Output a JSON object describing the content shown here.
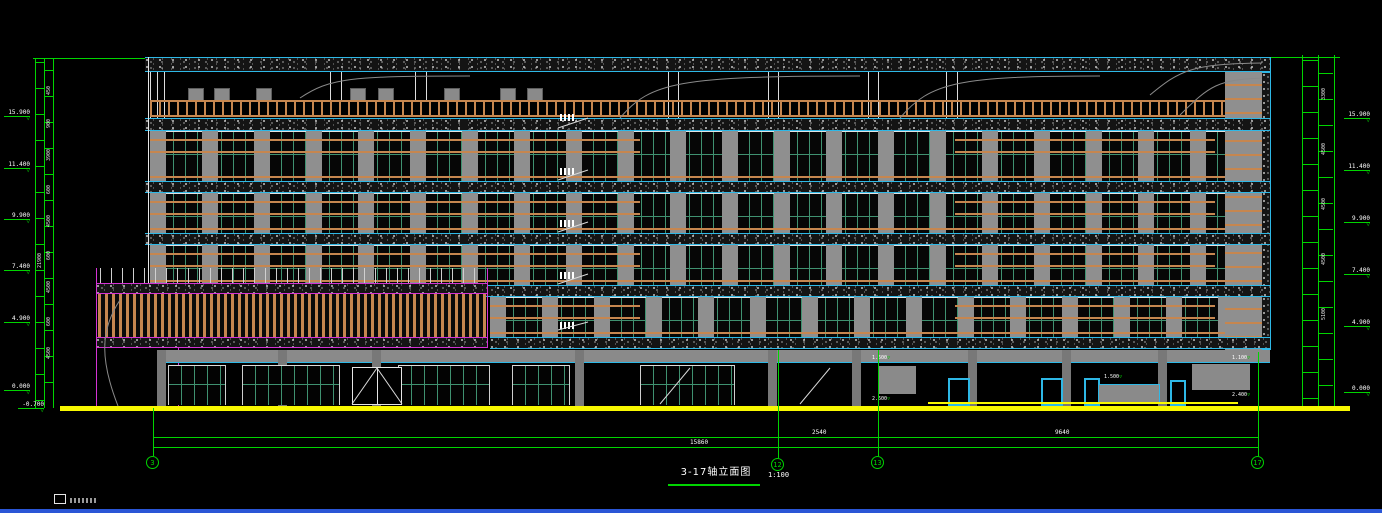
{
  "title_block": {
    "title": "3-17轴立面图",
    "scale": "1:100"
  },
  "grid": {
    "bubbles": [
      {
        "label": "3"
      },
      {
        "label": "12"
      },
      {
        "label": "13"
      },
      {
        "label": "17"
      }
    ]
  },
  "dims_bottom": {
    "seg_3_12": "15860",
    "seg_12_13": "2540",
    "seg_13_17": "9640"
  },
  "levels_left": [
    {
      "value": "15.900"
    },
    {
      "value": "11.400"
    },
    {
      "value": "9.900"
    },
    {
      "value": "7.400"
    },
    {
      "value": "4.900"
    },
    {
      "value": "0.000"
    },
    {
      "value": "-0.700"
    }
  ],
  "levels_right": [
    {
      "value": "15.900"
    },
    {
      "value": "11.400"
    },
    {
      "value": "9.900"
    },
    {
      "value": "7.400"
    },
    {
      "value": "4.900"
    },
    {
      "value": "0.000"
    }
  ],
  "dims_left": [
    "450",
    "900",
    "3900",
    "600",
    "4500",
    "600",
    "4500",
    "600",
    "4500",
    "21900"
  ],
  "dims_right": [
    "3300",
    "4500",
    "4500",
    "4500",
    "5100"
  ],
  "ground_marks": [
    {
      "value": "1.600"
    },
    {
      "value": "2.600"
    },
    {
      "value": "1.500"
    },
    {
      "value": "2.100"
    },
    {
      "value": "1.100"
    },
    {
      "value": "2.400"
    }
  ],
  "colors": {
    "dimension_green": "#00d400",
    "band_cyan": "#2eb8e6",
    "annex_magenta": "#d432d4",
    "louver_orange": "#c6864f",
    "ground_yellow": "#f8f800",
    "wall_grey": "#8f8f8f",
    "mullion_teal": "#3f9170",
    "footer_blue": "#2a56d6"
  }
}
